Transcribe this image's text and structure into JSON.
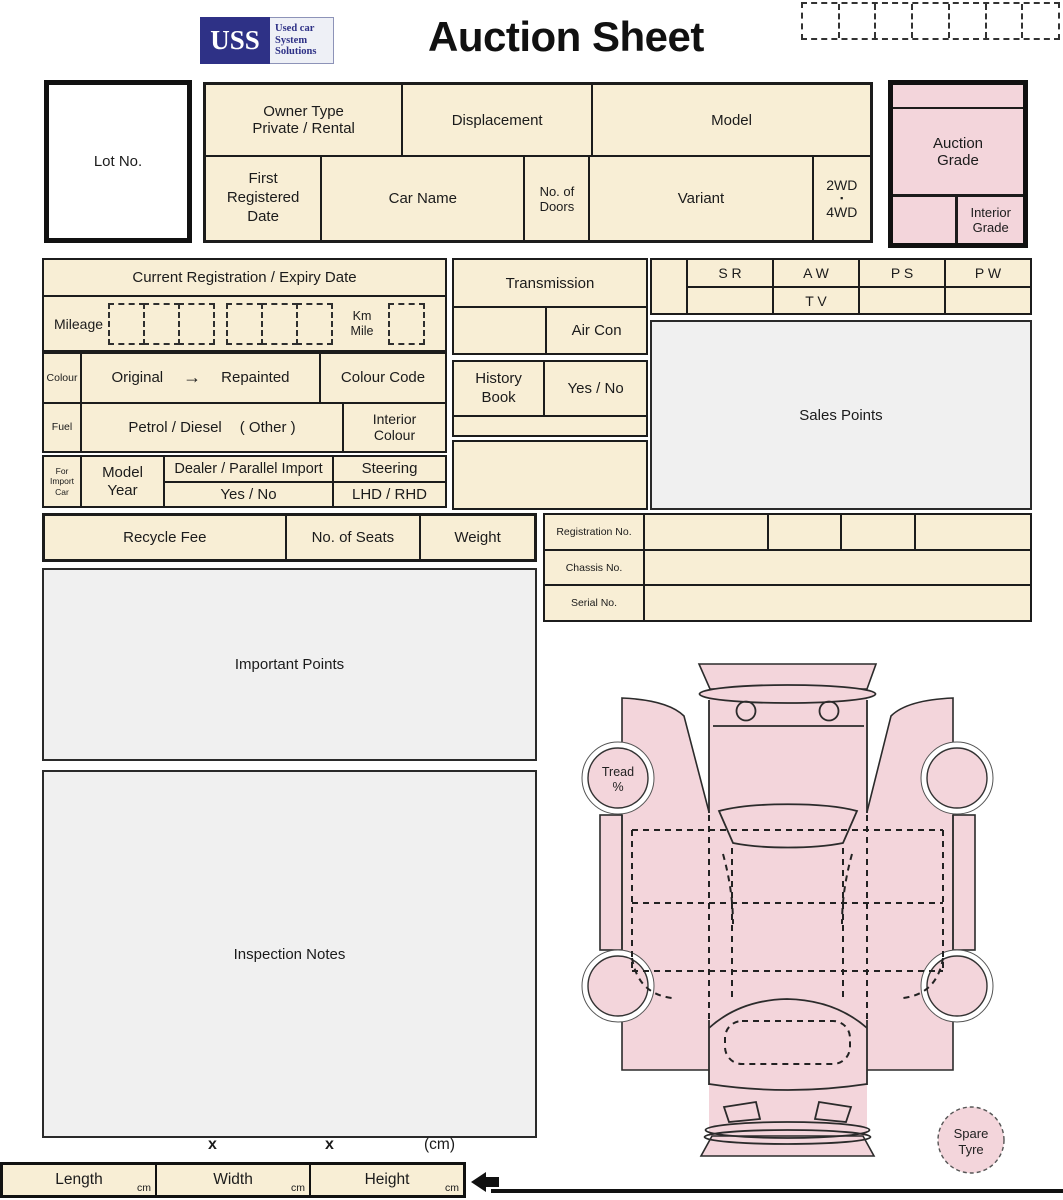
{
  "colors": {
    "cream": "#f8eed5",
    "pink": "#f3d5db",
    "grey_panel": "#f0f0f0",
    "navy": "#2e3186",
    "line": "#1c1c1c"
  },
  "header": {
    "logo_abbr": "USS",
    "logo_text": "Used car\nSystem\nSolutions",
    "title": "Auction Sheet",
    "code_boxes": 7
  },
  "lot": {
    "label": "Lot No."
  },
  "vehicle": {
    "owner_type": "Owner Type\nPrivate / Rental",
    "displacement": "Displacement",
    "model": "Model",
    "first_registered": "First\nRegistered\nDate",
    "car_name": "Car Name",
    "doors": "No. of\nDoors",
    "variant": "Variant",
    "drive_top": "2WD",
    "drive_sep": "▪",
    "drive_bottom": "4WD"
  },
  "grade": {
    "auction": "Auction\nGrade",
    "interior": "Interior\nGrade"
  },
  "registration": {
    "title": "Current Registration / Expiry Date",
    "mileage_label": "Mileage",
    "unit": "Km\nMile"
  },
  "colour": {
    "label": "Colour",
    "original": "Original",
    "arrow": "→",
    "repainted": "Repainted",
    "code": "Colour Code"
  },
  "fuel": {
    "label": "Fuel",
    "types": "Petrol / Diesel",
    "other": "( Other )",
    "interior_colour": "Interior\nColour"
  },
  "import_car": {
    "label": "For\nImport\nCar",
    "model_year": "Model\nYear",
    "dealer": "Dealer / Parallel Import",
    "yes_no": "Yes / No",
    "steering": "Steering",
    "lhd_rhd": "LHD / RHD"
  },
  "equipment": {
    "transmission": "Transmission",
    "air_con": "Air Con",
    "history_book": "History\nBook",
    "yes_no": "Yes / No"
  },
  "features": {
    "cols": [
      "S R",
      "A W",
      "P S",
      "P W"
    ],
    "tv": "T V"
  },
  "sales_points": {
    "label": "Sales Points"
  },
  "recycle": {
    "fee": "Recycle Fee",
    "seats": "No. of Seats",
    "weight": "Weight"
  },
  "ids": {
    "registration_no": "Registration No.",
    "chassis_no": "Chassis No.",
    "serial_no": "Serial No."
  },
  "notes": {
    "important": "Important Points",
    "inspection": "Inspection Notes"
  },
  "diagram": {
    "tread_line1": "Tread",
    "tread_line2": "%",
    "spare_line1": "Spare",
    "spare_line2": "Tyre"
  },
  "dimensions": {
    "times": "x",
    "cm_note": "(cm)",
    "length": "Length",
    "width": "Width",
    "height": "Height",
    "unit": "cm"
  }
}
